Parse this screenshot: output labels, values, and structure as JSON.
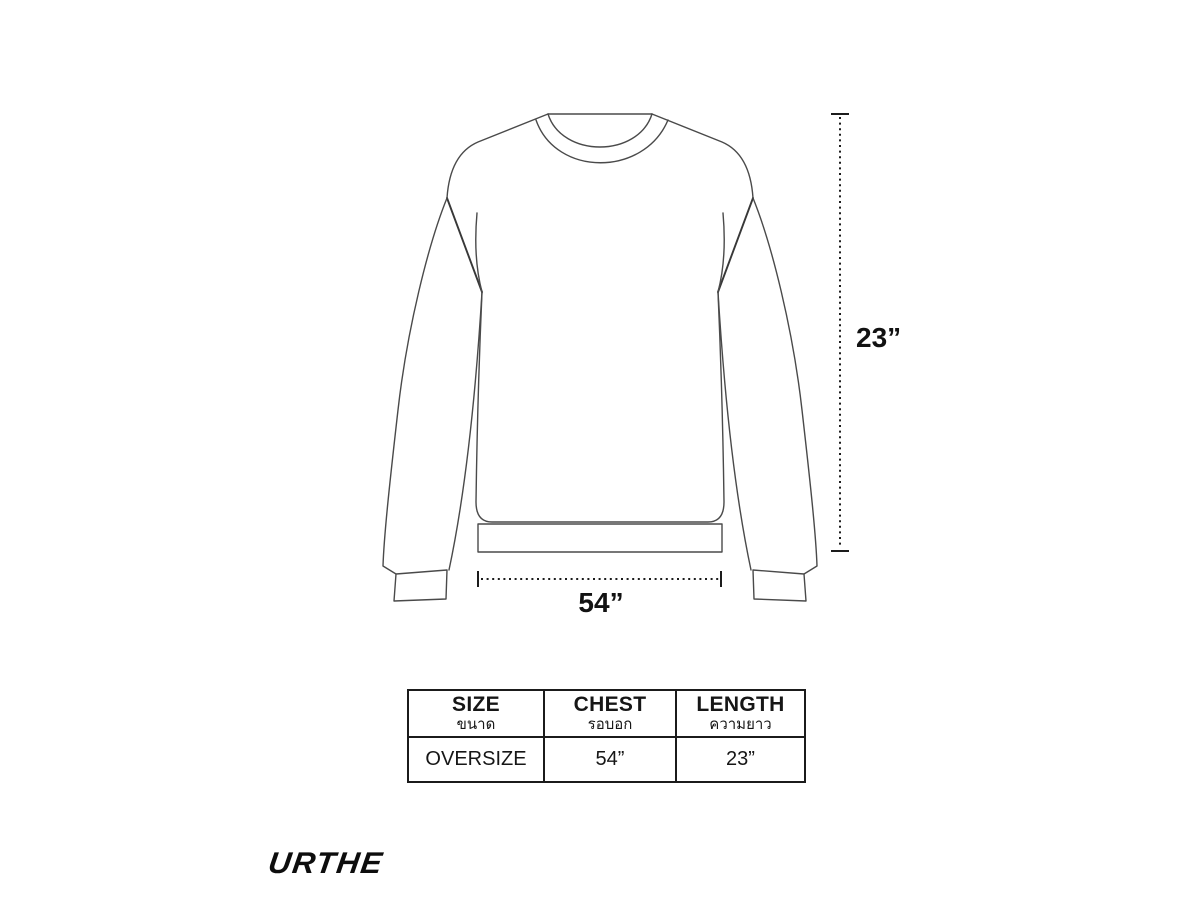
{
  "page": {
    "background": "#ffffff",
    "kind": "garment-size-chart"
  },
  "diagram": {
    "garment": "oversize-crewneck-sweatshirt-flat-sketch",
    "length_label": "23”",
    "chest_label": "54”",
    "line_color": "#4a4a4a",
    "dimension_color": "#1c1c1c"
  },
  "size_table": {
    "columns": [
      {
        "en": "SIZE",
        "th": "ขนาด"
      },
      {
        "en": "CHEST",
        "th": "รอบอก"
      },
      {
        "en": "LENGTH",
        "th": "ความยาว"
      }
    ],
    "rows": [
      {
        "size": "OVERSIZE",
        "chest": "54”",
        "length": "23”"
      }
    ]
  },
  "brand": {
    "logo_text": "URTHE"
  }
}
